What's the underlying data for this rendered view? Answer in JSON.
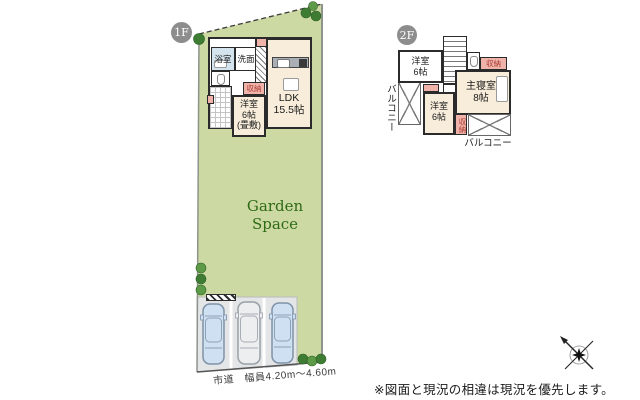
{
  "badges": {
    "floor1": "1F",
    "floor2": "2F"
  },
  "floor1": {
    "bath": "浴室",
    "wash": "洗面",
    "closet": "収納",
    "tatami_room": "洋室\n6帖\n(畳敷)",
    "ldk": "LDK\n15.5帖"
  },
  "floor2": {
    "room_top": "洋室\n6帖",
    "closet_top": "収納",
    "master": "主寝室\n8帖",
    "room_bottom": "洋室\n6帖",
    "closet_bottom": "収納",
    "balcony_left": "バルコニー",
    "balcony_bottom": "バルコニー"
  },
  "site": {
    "garden_label": "Garden Space",
    "road_label": "市道　幅員4.20m〜4.60m"
  },
  "footer": {
    "disclaimer": "※図面と現況の相違は現況を優先します。"
  },
  "colors": {
    "site_green": "#ccd9a2",
    "room_cream": "#f7edda",
    "closet_pink": "#f0b3aa",
    "bath_blue": "#d4e4ef",
    "parking_gray": "#e4e5e7",
    "car_blue": "#cfe0f2",
    "tree_green": "#3e7c33",
    "garden_text_green": "#2f6b17"
  }
}
